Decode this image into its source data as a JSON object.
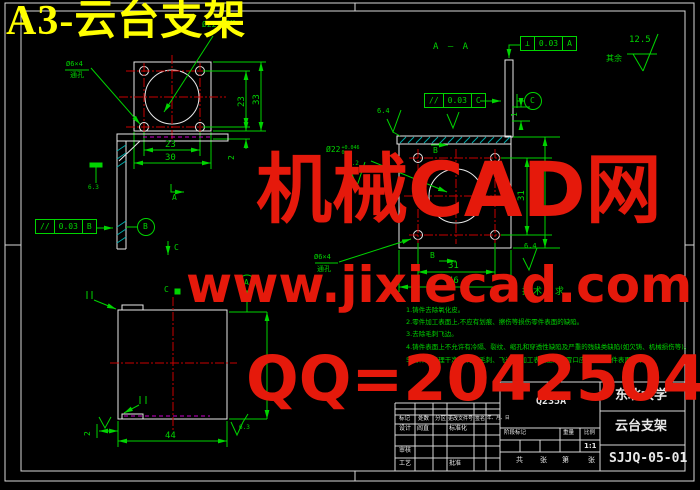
{
  "sheet": {
    "title": "A3-云台支架"
  },
  "watermark": {
    "line1": "机械CAD网",
    "line2": "www.jixiecad.com",
    "line3": "QQ=20425042"
  },
  "colors": {
    "background": "#000000",
    "outline": "#e8e8e8",
    "annotation_green": "#00d400",
    "centerline_red": "#c80000",
    "hidden_magenta": "#cc00cc",
    "hatch_cyan": "#00aaaa",
    "watermark_red": "#e5190b",
    "title_yellow": "#ffff00"
  },
  "labels": {
    "section_aa": "A — A",
    "view_a": "A",
    "section_b": "B",
    "section_c": "C",
    "datum_a": "A",
    "datum_b": "B",
    "datum_c": "C",
    "rest": "其余",
    "hole_dia": "Ø6×4",
    "hole_type": "通孔",
    "bore_dia": "Ø22",
    "bore_tol_up": "+0.046",
    "bore_tol_dn": "0"
  },
  "fcf": {
    "parallel_b": {
      "sym": "//",
      "val": "0.03",
      "ref": "B"
    },
    "parallel_c": {
      "sym": "//",
      "val": "0.03",
      "ref": "C"
    },
    "perp_a": {
      "sym": "⊥",
      "val": "0.03",
      "ref": "A"
    }
  },
  "roughness": {
    "r125": "12.5",
    "r64": "6.4",
    "r63": "6.3",
    "r32": "3.2"
  },
  "dims": {
    "d1": "1",
    "d2": "2",
    "d23": "23",
    "d30": "30",
    "d31": "31",
    "d33": "33",
    "d43": "43",
    "d44": "44",
    "d46": "46"
  },
  "notes": {
    "heading": "技术要求",
    "items": [
      "1.铸件去除氧化皮。",
      "2.零件加工表面上,不应有划痕、擦伤等损伤零件表面的缺陷。",
      "3.去除毛刺飞边。",
      "4.铸件表面上不允许有冷隔、裂纹、缩孔和穿透性缺陷及严重的残缺类缺陷(如欠铸、机械损伤等)。",
      "5.铸件应清理干净,不得有毛刺、飞边,非加工表面上的浇冒口应清理与铸件表面齐平。"
    ]
  },
  "title_block": {
    "material": "Q235A",
    "org": "东北大学",
    "part": "云台支架",
    "dwg_no": "SJJQ-05-01",
    "scale_val": "1:1",
    "rev_headers": [
      "标记",
      "处数",
      "分区",
      "更改文件号",
      "签名",
      "年、月、日"
    ],
    "row_design": "设计",
    "designer": "阎直",
    "row_std": "标准化",
    "row_check": "审核",
    "row_process": "工艺",
    "row_approve": "批准",
    "stage": "阶段标记",
    "weight": "重量",
    "scale": "比例",
    "sheet_a": "共",
    "sheet_b": "张",
    "sheet_c": "第",
    "sheet_d": "张"
  }
}
